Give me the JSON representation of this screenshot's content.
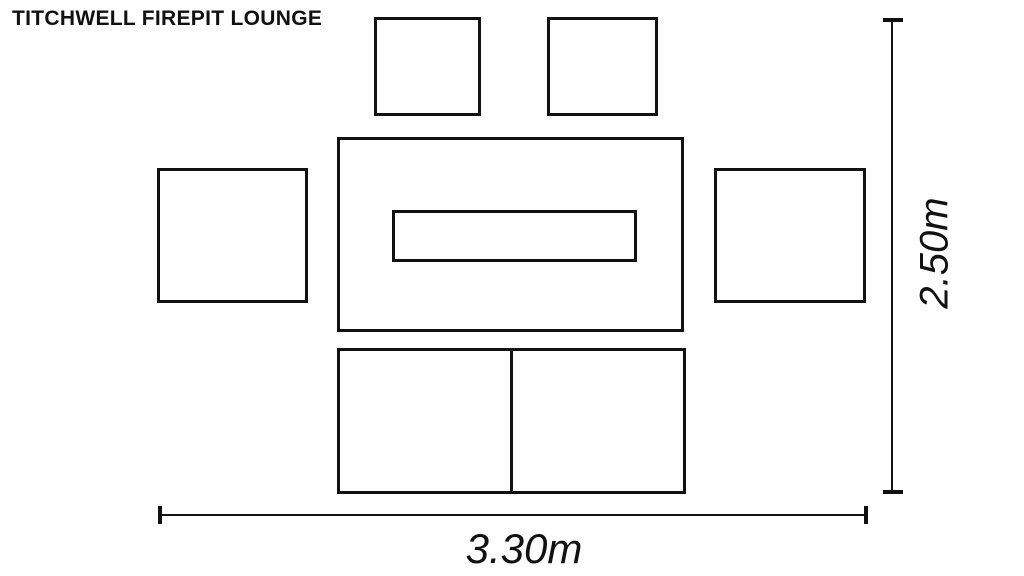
{
  "page": {
    "background_color": "#ffffff",
    "line_color": "#111111"
  },
  "header": {
    "title": "TITCHWELL FIREPIT LOUNGE"
  },
  "diagram": {
    "type": "furniture-layout-plan",
    "furniture": [
      {
        "id": "stool-top-left",
        "shape": "square"
      },
      {
        "id": "stool-top-right",
        "shape": "square"
      },
      {
        "id": "chair-left",
        "shape": "rectangle"
      },
      {
        "id": "chair-right",
        "shape": "rectangle"
      },
      {
        "id": "firepit-table",
        "shape": "rectangle",
        "inset": "firepit-opening"
      },
      {
        "id": "two-seat-sofa",
        "shape": "rectangle",
        "sections": 2
      }
    ],
    "dimensions": {
      "height_label": "2.50m",
      "width_label": "3.30m"
    }
  }
}
